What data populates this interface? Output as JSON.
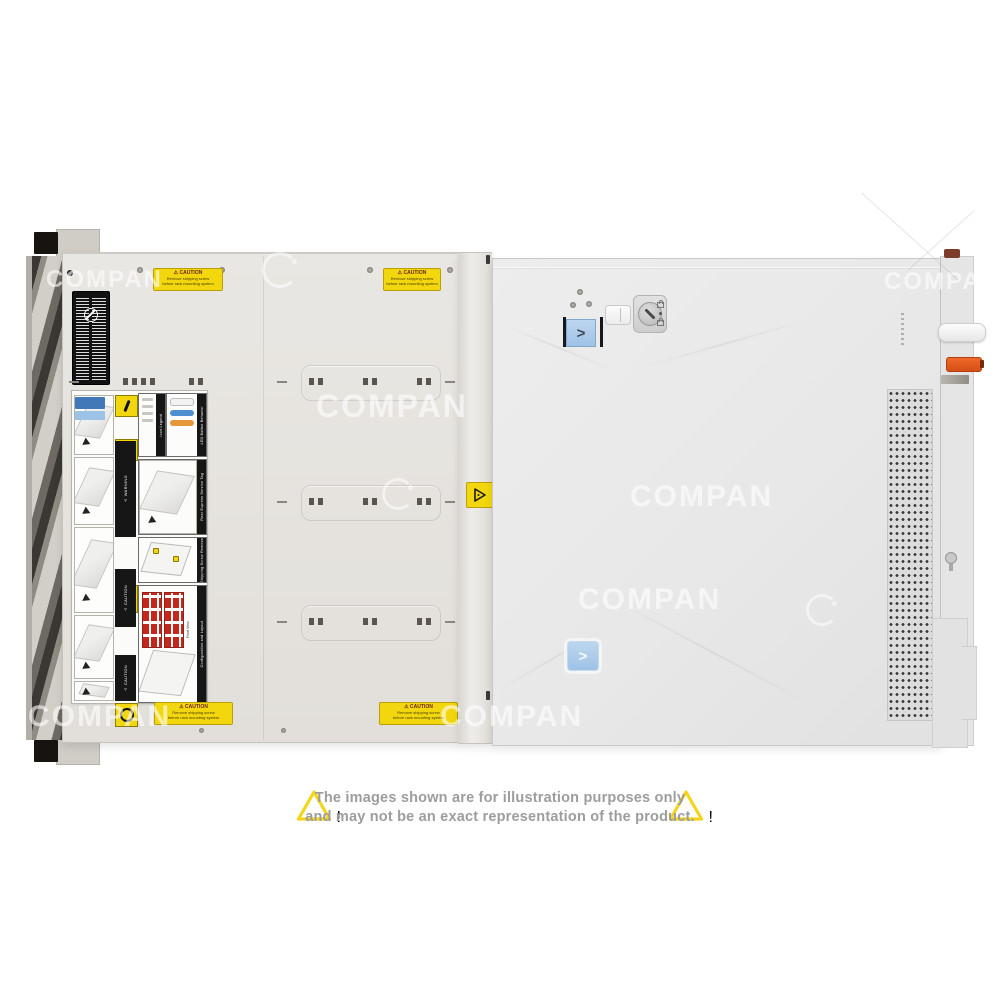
{
  "colors": {
    "caution_yellow": "#f2d70e",
    "latch_blue": "#a9c8e8",
    "lever_orange": "#e2561c",
    "led_blue": "#4d8fd1",
    "led_orange": "#e5973a",
    "drive_grid_red": "#c4281c",
    "disclaimer_yellow": "#f6d41c",
    "disclaimer_text": "#9d9d9d"
  },
  "watermark": {
    "text": "COMPAN"
  },
  "server": {
    "caution_sticker": {
      "title": "⚠ CAUTION",
      "line1": "Remove shipping screw",
      "line2": "before rack mounting system"
    },
    "label_panel": {
      "icon_legend_title": "Icon Legend",
      "led_title": "LED Button Behavior",
      "service_tag_title": "Rear Express Service Tag",
      "shipping_title": "Shipping Screw Removal",
      "config_title": "Configuration and Layout",
      "warning_bar": "⚠ WARNING",
      "caution_bar": "⚠ CAUTION",
      "front_view": "Front View"
    },
    "cover": {
      "latch_chevron": ">"
    }
  },
  "disclaimer": {
    "warning_mark": "!",
    "line1": "The images shown are for illustration purposes only",
    "line2": "and may not be an exact representation of the product."
  }
}
